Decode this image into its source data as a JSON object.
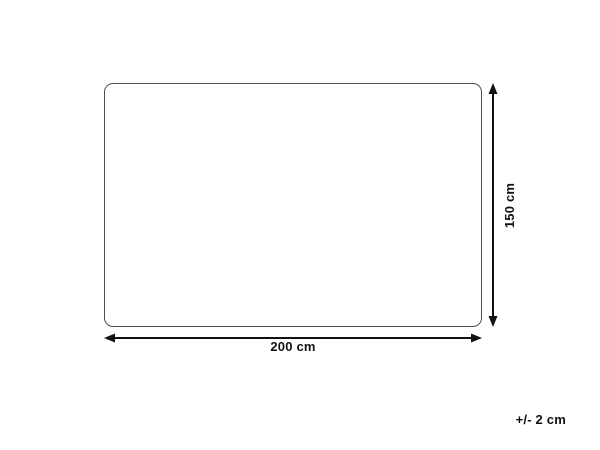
{
  "diagram": {
    "width_label": "200 cm",
    "height_label": "150 cm",
    "tolerance_label": "+/- 2 cm",
    "colors": {
      "background": "#ffffff",
      "outline": "#4f4f4f",
      "arrow": "#111111",
      "text": "#111111"
    }
  }
}
